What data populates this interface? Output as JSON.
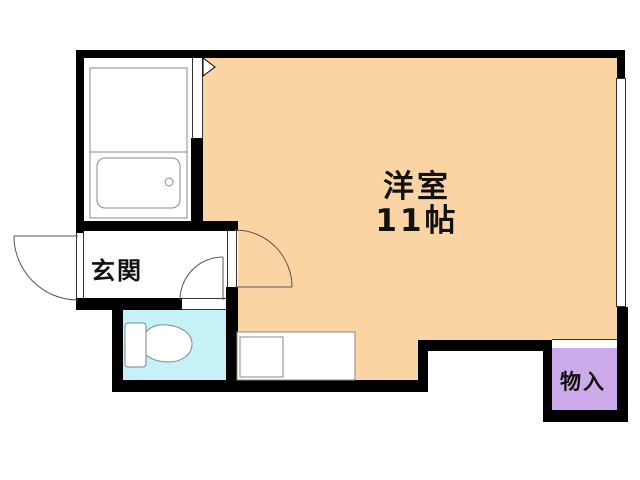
{
  "plan": {
    "type": "apartment-floorplan",
    "rooms": {
      "main": {
        "label": "洋室",
        "size": "11帖",
        "fill": "#FBD4A3"
      },
      "genkan": {
        "label": "玄関",
        "fill": "#FFFFFF"
      },
      "toilet": {
        "label": "",
        "fill": "#C6F2F7"
      },
      "storage": {
        "label": "物入",
        "fill": "#CDAAE9"
      },
      "bathroom": {
        "label": "",
        "fill": "#FFFFFF"
      }
    },
    "fixtures": {
      "bathtub": "bathtub-with-drain",
      "vanity": "bath-unit-upper-section",
      "toilet": "toilet-bowl-and-tank",
      "kitchen_counter": "counter-with-sink",
      "window": "right-wall-window",
      "doors": [
        "entrance-door-swing",
        "main-room-door-swing",
        "toilet-door-swing",
        "bathroom-door-marker"
      ]
    },
    "colors": {
      "wall": "#000000",
      "background": "#FFFFFF",
      "fixture_line": "#888888",
      "door_arc": "#555555",
      "text": "#111111"
    }
  }
}
